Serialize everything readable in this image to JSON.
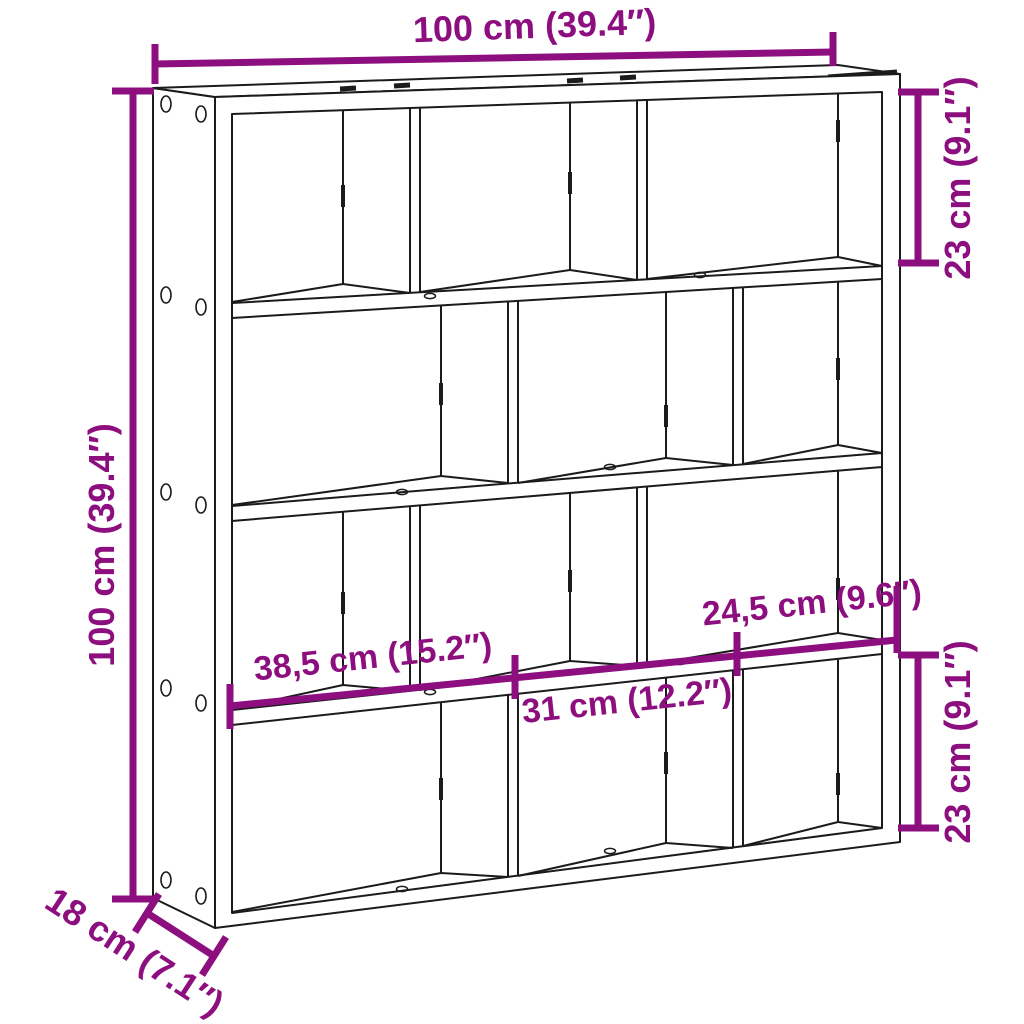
{
  "canvas": {
    "width": 1024,
    "height": 1024,
    "background": "#ffffff"
  },
  "style": {
    "dimension_color": "#8D0E7F",
    "line_color": "#1B1B1B"
  },
  "labels": {
    "overall_width": "100 cm (39.4″)",
    "overall_height": "100 cm (39.4″)",
    "depth": "18 cm (7.1″)",
    "compartment_height_top": "23 cm (9.1″)",
    "compartment_height_bottom": "23 cm (9.1″)",
    "compartment_width_left": "38,5 cm (15.2″)",
    "compartment_width_middle": "31 cm (12.2″)",
    "compartment_width_right": "24,5 cm (9.6″)"
  }
}
